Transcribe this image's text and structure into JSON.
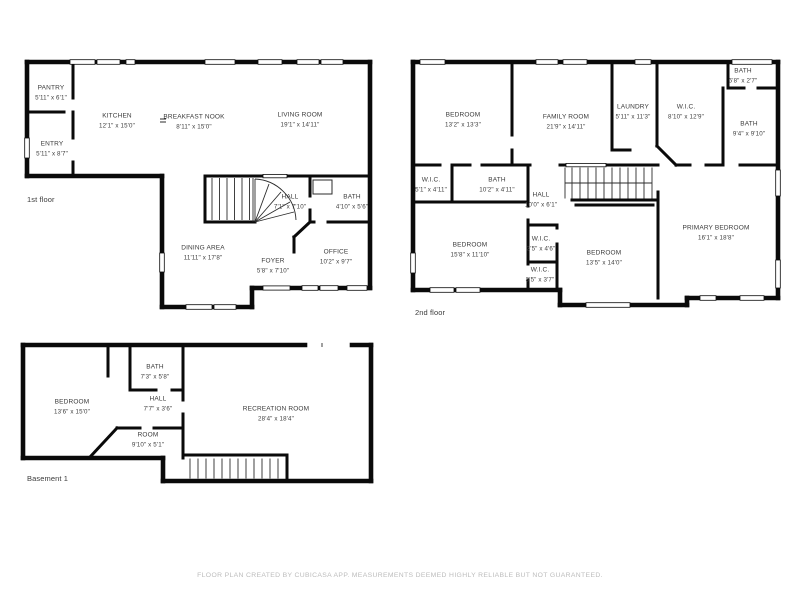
{
  "colors": {
    "background": "#ffffff",
    "wall": "#0a0a0a",
    "room_text": "#3a3a3a",
    "footer_text": "#bcbcbc"
  },
  "footer": {
    "disclaimer": "FLOOR PLAN CREATED BY CUBICASA APP. MEASUREMENTS DEEMED HIGHLY RELIABLE BUT NOT GUARANTEED."
  },
  "floors": [
    {
      "label": "1st floor",
      "rooms": [
        {
          "name": "PANTRY",
          "dims": "5'11\" x 6'1\""
        },
        {
          "name": "KITCHEN",
          "dims": "12'1\" x 15'0\""
        },
        {
          "name": "BREAKFAST NOOK",
          "dims": "8'11\" x 15'0\""
        },
        {
          "name": "LIVING ROOM",
          "dims": "19'1\" x 14'11\""
        },
        {
          "name": "ENTRY",
          "dims": "5'11\" x 8'7\""
        },
        {
          "name": "HALL",
          "dims": "7'1\" x 7'10\""
        },
        {
          "name": "BATH",
          "dims": "4'10\" x 5'6\""
        },
        {
          "name": "DINING AREA",
          "dims": "11'11\" x 17'8\""
        },
        {
          "name": "FOYER",
          "dims": "5'8\" x 7'10\""
        },
        {
          "name": "OFFICE",
          "dims": "10'2\" x 9'7\""
        }
      ]
    },
    {
      "label": "2nd floor",
      "rooms": [
        {
          "name": "BEDROOM",
          "dims": "13'2\" x 13'3\""
        },
        {
          "name": "FAMILY ROOM",
          "dims": "21'9\" x 14'11\""
        },
        {
          "name": "LAUNDRY",
          "dims": "5'11\" x 11'3\""
        },
        {
          "name": "W.I.C.",
          "dims": "8'10\" x 12'9\""
        },
        {
          "name": "BATH",
          "dims": "6'8\" x 2'7\""
        },
        {
          "name": "BATH",
          "dims": "9'4\" x 9'10\""
        },
        {
          "name": "W.I.C.",
          "dims": "5'1\" x 4'11\""
        },
        {
          "name": "BATH",
          "dims": "10'2\" x 4'11\""
        },
        {
          "name": "HALL",
          "dims": "10'0\" x 6'1\""
        },
        {
          "name": "BEDROOM",
          "dims": "15'8\" x 11'10\""
        },
        {
          "name": "W.I.C.",
          "dims": "3'5\" x 4'6\""
        },
        {
          "name": "W.I.C.",
          "dims": "3'5\" x 3'7\""
        },
        {
          "name": "BEDROOM",
          "dims": "13'5\" x 14'0\""
        },
        {
          "name": "PRIMARY BEDROOM",
          "dims": "16'1\" x 18'8\""
        }
      ]
    },
    {
      "label": "Basement 1",
      "rooms": [
        {
          "name": "BEDROOM",
          "dims": "13'6\" x 15'0\""
        },
        {
          "name": "BATH",
          "dims": "7'3\" x 5'8\""
        },
        {
          "name": "HALL",
          "dims": "7'7\" x 3'6\""
        },
        {
          "name": "ROOM",
          "dims": "9'10\" x 5'1\""
        },
        {
          "name": "RECREATION ROOM",
          "dims": "28'4\" x 18'4\""
        }
      ]
    }
  ]
}
